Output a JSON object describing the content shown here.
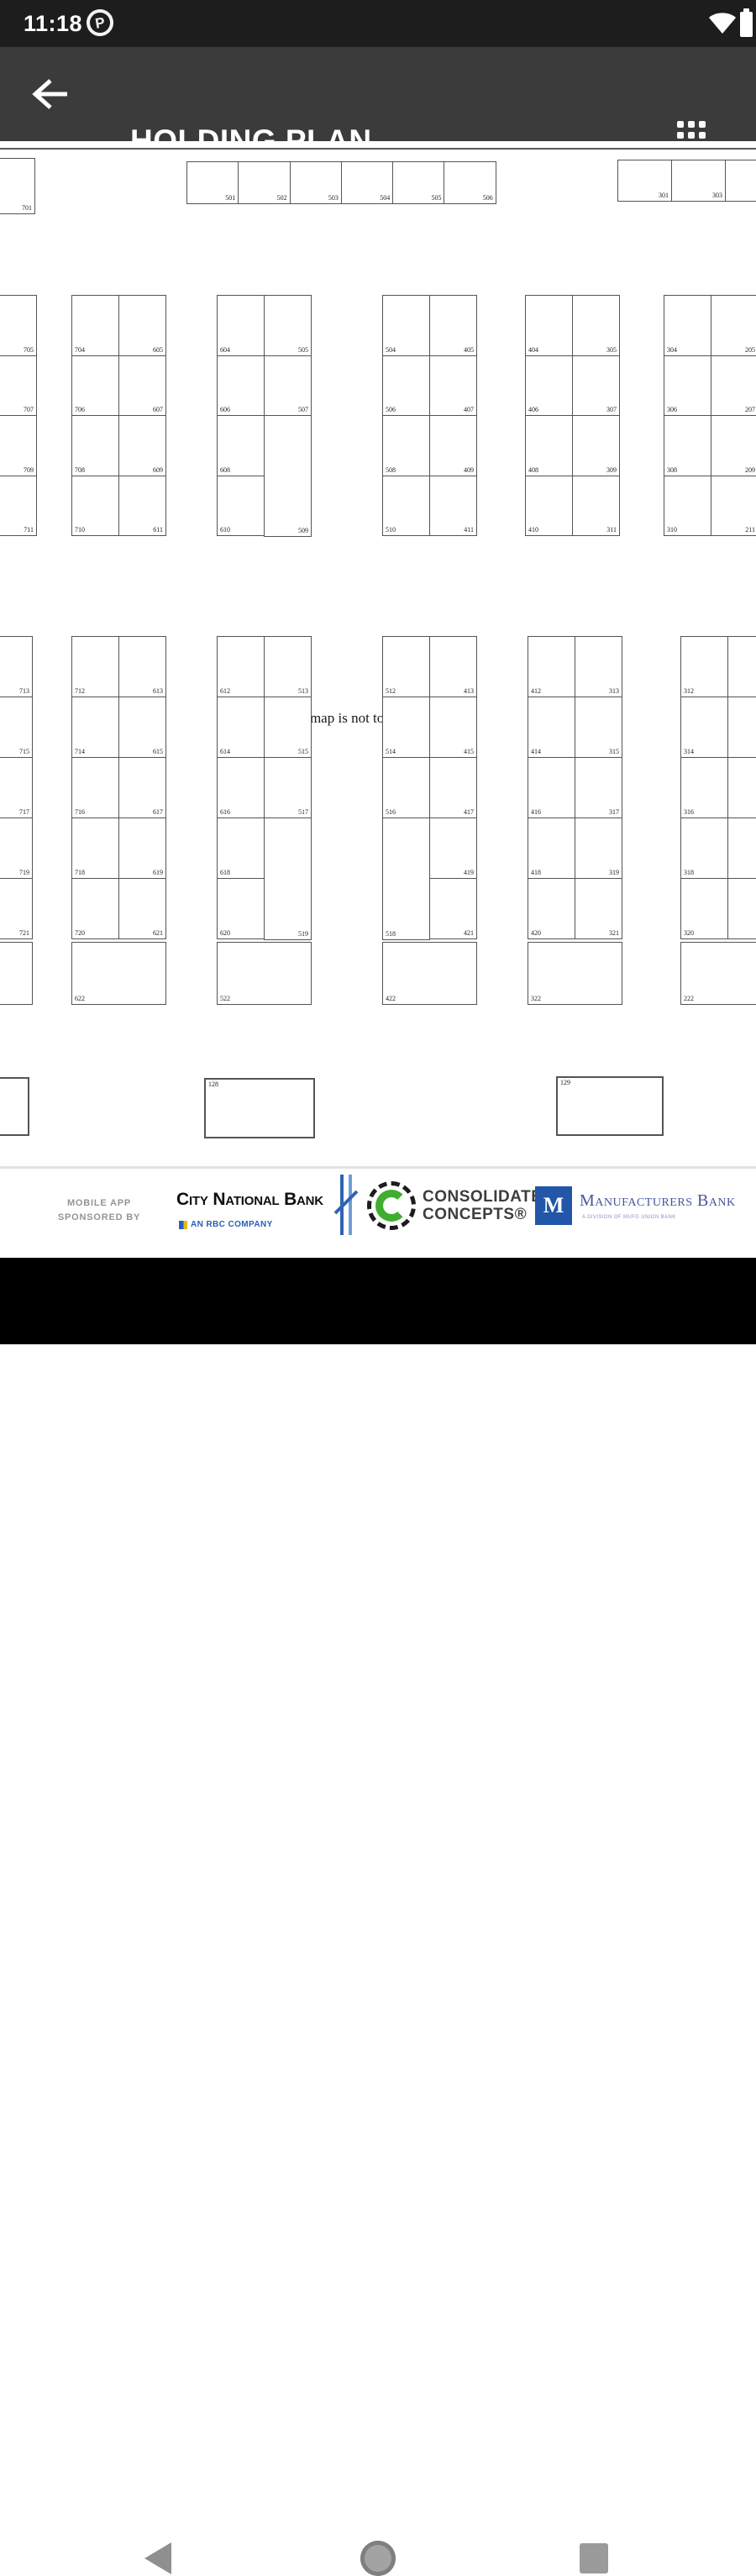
{
  "status_bar": {
    "time": "11:18",
    "notification_badge": "P"
  },
  "app_bar": {
    "title": "HOLDING PLAN"
  },
  "map": {
    "note": "This map is not to scale",
    "entrance_label": "ENTRANCE",
    "top_row_left": [
      "701"
    ],
    "top_row_middle": [
      "501",
      "502",
      "503",
      "504",
      "505",
      "506"
    ],
    "top_row_right": [
      "301",
      "303",
      ""
    ],
    "upper_blocks": [
      {
        "left": [],
        "right": [
          "705",
          "707",
          "709",
          "711"
        ]
      },
      {
        "left": [
          "704",
          "706",
          "708",
          "710"
        ],
        "right": [
          "605",
          "607",
          "609",
          "611"
        ]
      },
      {
        "left": [
          "604",
          "606",
          "608",
          "610"
        ],
        "right": [
          "505",
          "507",
          {
            "n": "509",
            "span": 2
          }
        ]
      },
      {
        "left": [
          "504",
          "506",
          "508",
          "510"
        ],
        "right": [
          "405",
          "407",
          "409",
          "411"
        ]
      },
      {
        "left": [
          "404",
          "406",
          "408",
          "410"
        ],
        "right": [
          "305",
          "307",
          "309",
          "311"
        ]
      },
      {
        "left": [
          "304",
          "306",
          "308",
          "310"
        ],
        "right": [
          "205",
          "207",
          "209",
          "211"
        ]
      }
    ],
    "lower_blocks": [
      {
        "left": [],
        "right": [
          "713",
          "715",
          "717",
          "719",
          "721"
        ],
        "bottom": ""
      },
      {
        "left": [
          "712",
          "714",
          "716",
          "718",
          "720"
        ],
        "right": [
          "613",
          "615",
          "617",
          "619",
          "621"
        ],
        "bottom": "622"
      },
      {
        "left": [
          "612",
          "614",
          "616",
          "618",
          "620"
        ],
        "right": [
          "513",
          "515",
          "517",
          {
            "n": "519",
            "span": 2
          }
        ],
        "bottom": "522"
      },
      {
        "left": [
          "512",
          "514",
          "516",
          {
            "n": "518",
            "span": 2
          }
        ],
        "right": [
          "413",
          "415",
          "417",
          "419",
          "421"
        ],
        "bottom": "422"
      },
      {
        "left": [
          "412",
          "414",
          "416",
          "418",
          "420"
        ],
        "right": [
          "313",
          "315",
          "317",
          "319",
          "321"
        ],
        "bottom": "322"
      },
      {
        "left": [
          "312",
          "314",
          "316",
          "318",
          "320"
        ],
        "right": [
          "213",
          "215",
          "217",
          "219",
          "221"
        ],
        "bottom": "222"
      }
    ],
    "bottom_boxes": [
      "",
      "128",
      "129"
    ]
  },
  "sponsors": {
    "label_line1": "MOBILE APP",
    "label_line2": "SPONSORED BY",
    "city_national_bank": {
      "name": "City National Bank",
      "subtitle": "AN RBC COMPANY"
    },
    "consolidated_concepts": {
      "line1": "CONSOLIDATED",
      "line2": "CONCEPTS®"
    },
    "manufacturers_bank": {
      "name": "Manufacturers Bank",
      "monogram": "M",
      "tagline": "A DIVISION OF MUFG UNION BANK"
    }
  }
}
